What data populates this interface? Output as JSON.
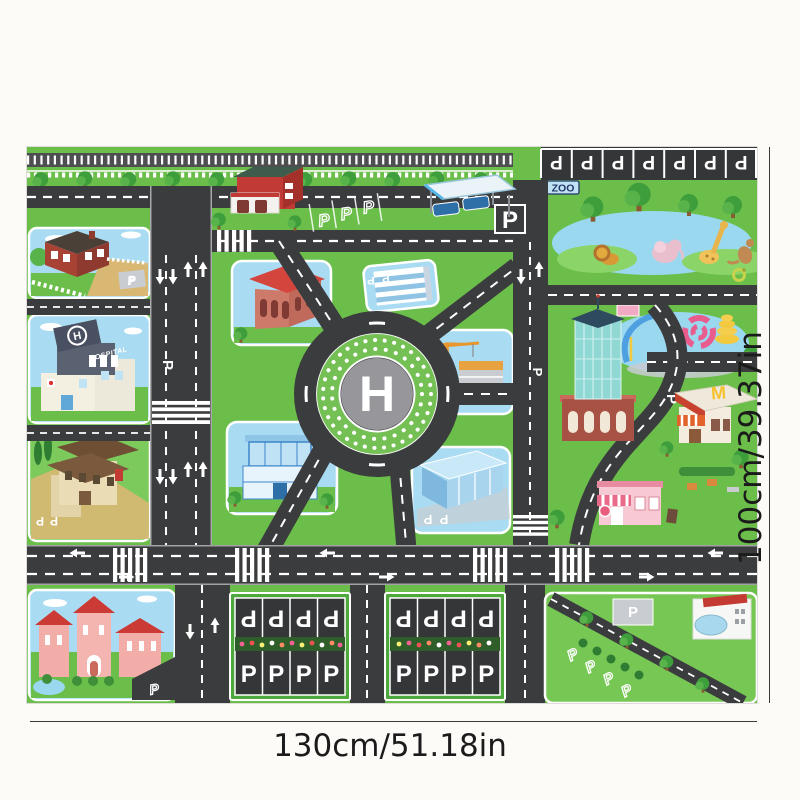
{
  "annotations": {
    "width_label": "130cm/51.18in",
    "height_label": "100cm/39.37in"
  },
  "mat": {
    "labels": {
      "zoo_sign": "ZOO",
      "hospital_sign": "HOSPITAL",
      "helipad_letter": "H",
      "hospital_helipad_letter": "H",
      "parking_letter": "P",
      "burger_sign_letter": "M"
    },
    "colors": {
      "grass": "#6CBE4B",
      "road_asphalt": "#3B3C3E",
      "road_marking": "#FFFFFF",
      "sky_block_fill": "#A9DCF2",
      "helipad_pad_gray": "#97979B",
      "helipad_dot_ring_green": "#74C055",
      "parking_lot_asphalt": "#353638",
      "railroad_gray": "#4E4E50",
      "zoo_sign_fill": "#BFE3F2",
      "zoo_sign_text": "#23356B",
      "dimension_line": "#3A3A3A"
    },
    "zoo_animal_icons": [
      "lion",
      "elephant",
      "giraffe",
      "kangaroo",
      "snake"
    ],
    "building_names": [
      "red-house",
      "hospital",
      "mansion",
      "school",
      "fire-station",
      "bus-shelter",
      "civic-hall",
      "office-block",
      "construction-site",
      "glass-office",
      "car-showroom",
      "skyscraper",
      "burger-shop",
      "cafe",
      "exhibition-hall"
    ]
  }
}
